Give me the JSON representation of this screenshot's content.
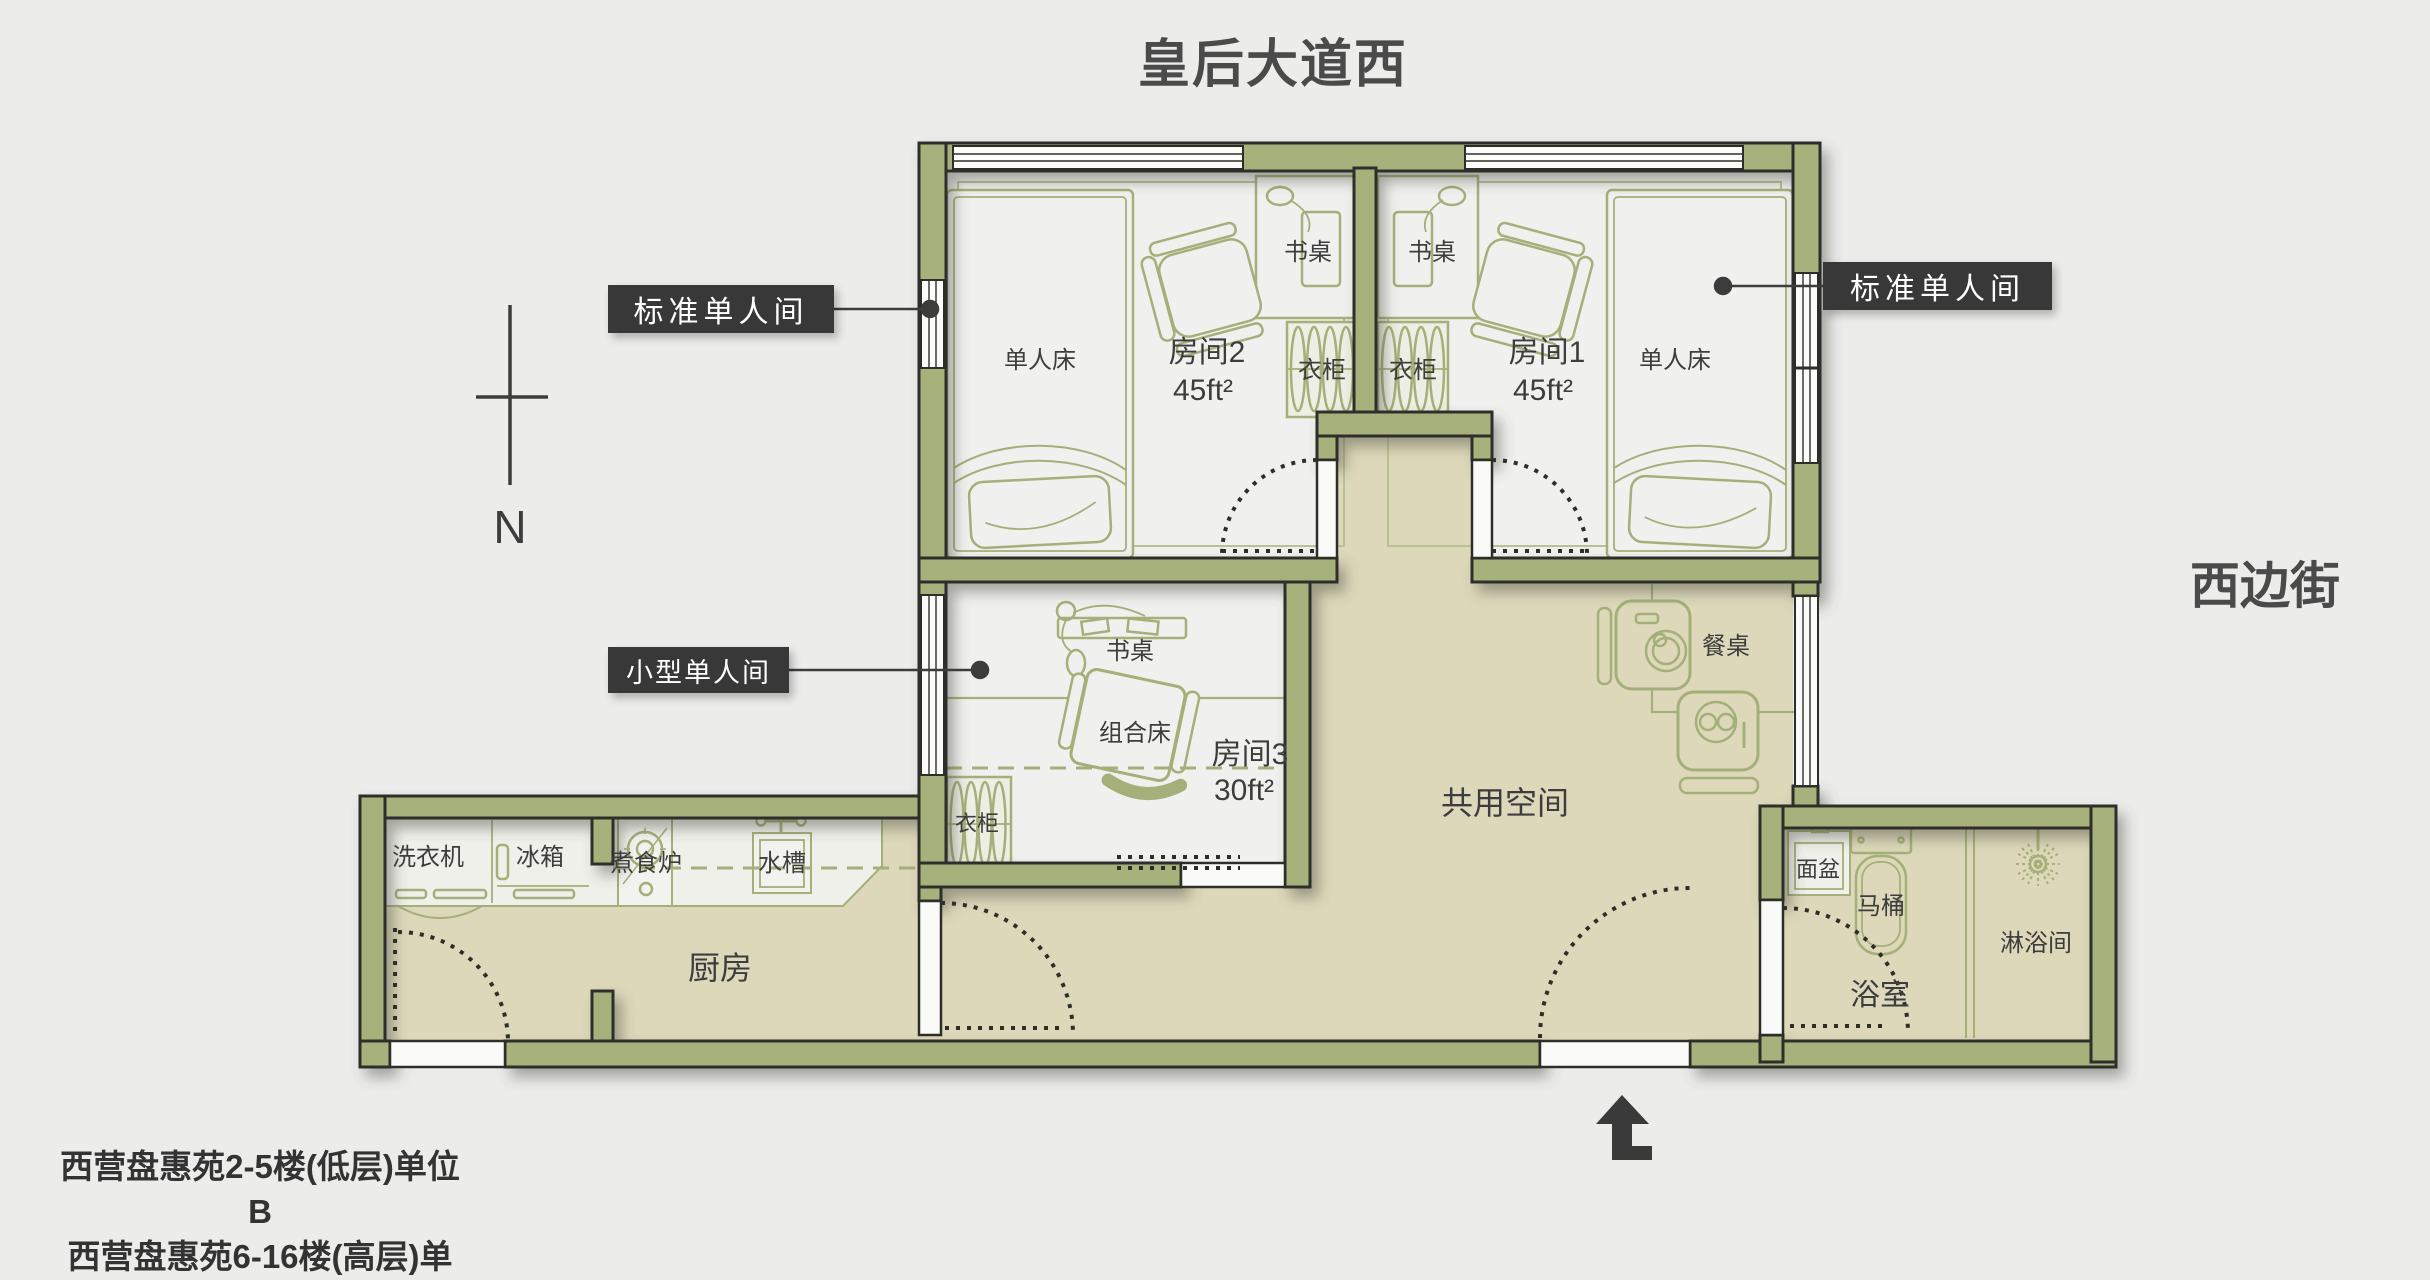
{
  "title": "皇后大道西",
  "street_right": "西边街",
  "north_label": "N",
  "captions": {
    "line1": "西营盘惠苑2-5楼(低层)单位B",
    "line2": "西营盘惠苑6-16楼(高层)单位B"
  },
  "callouts": {
    "standard_single": "标准单人间",
    "small_single": "小型单人间"
  },
  "rooms": {
    "room1": {
      "name": "房间1",
      "area": "45ft²"
    },
    "room2": {
      "name": "房间2",
      "area": "45ft²"
    },
    "room3": {
      "name": "房间3",
      "area": "30ft²"
    },
    "common": "共用空间",
    "kitchen": "厨房",
    "bathroom": "浴室"
  },
  "furniture": {
    "single_bed": "单人床",
    "desk": "书桌",
    "wardrobe": "衣柜",
    "combo_bed": "组合床",
    "dining_table": "餐桌",
    "washing_machine": "洗衣机",
    "fridge": "冰箱",
    "stove": "煮食炉",
    "sink": "水槽",
    "basin": "面盆",
    "toilet": "马桶",
    "shower": "淋浴间"
  },
  "colors": {
    "wall_fill": "#a6b17b",
    "wall_stroke": "#2e2e29",
    "room_floor": "#f0f0ee",
    "shared_floor": "#dcd8b9",
    "furniture_line": "#a4af79",
    "label_box": "#383838",
    "label_text": "#ffffff",
    "text_dark": "#3d3d3d",
    "page_bg": "#ececeb"
  }
}
